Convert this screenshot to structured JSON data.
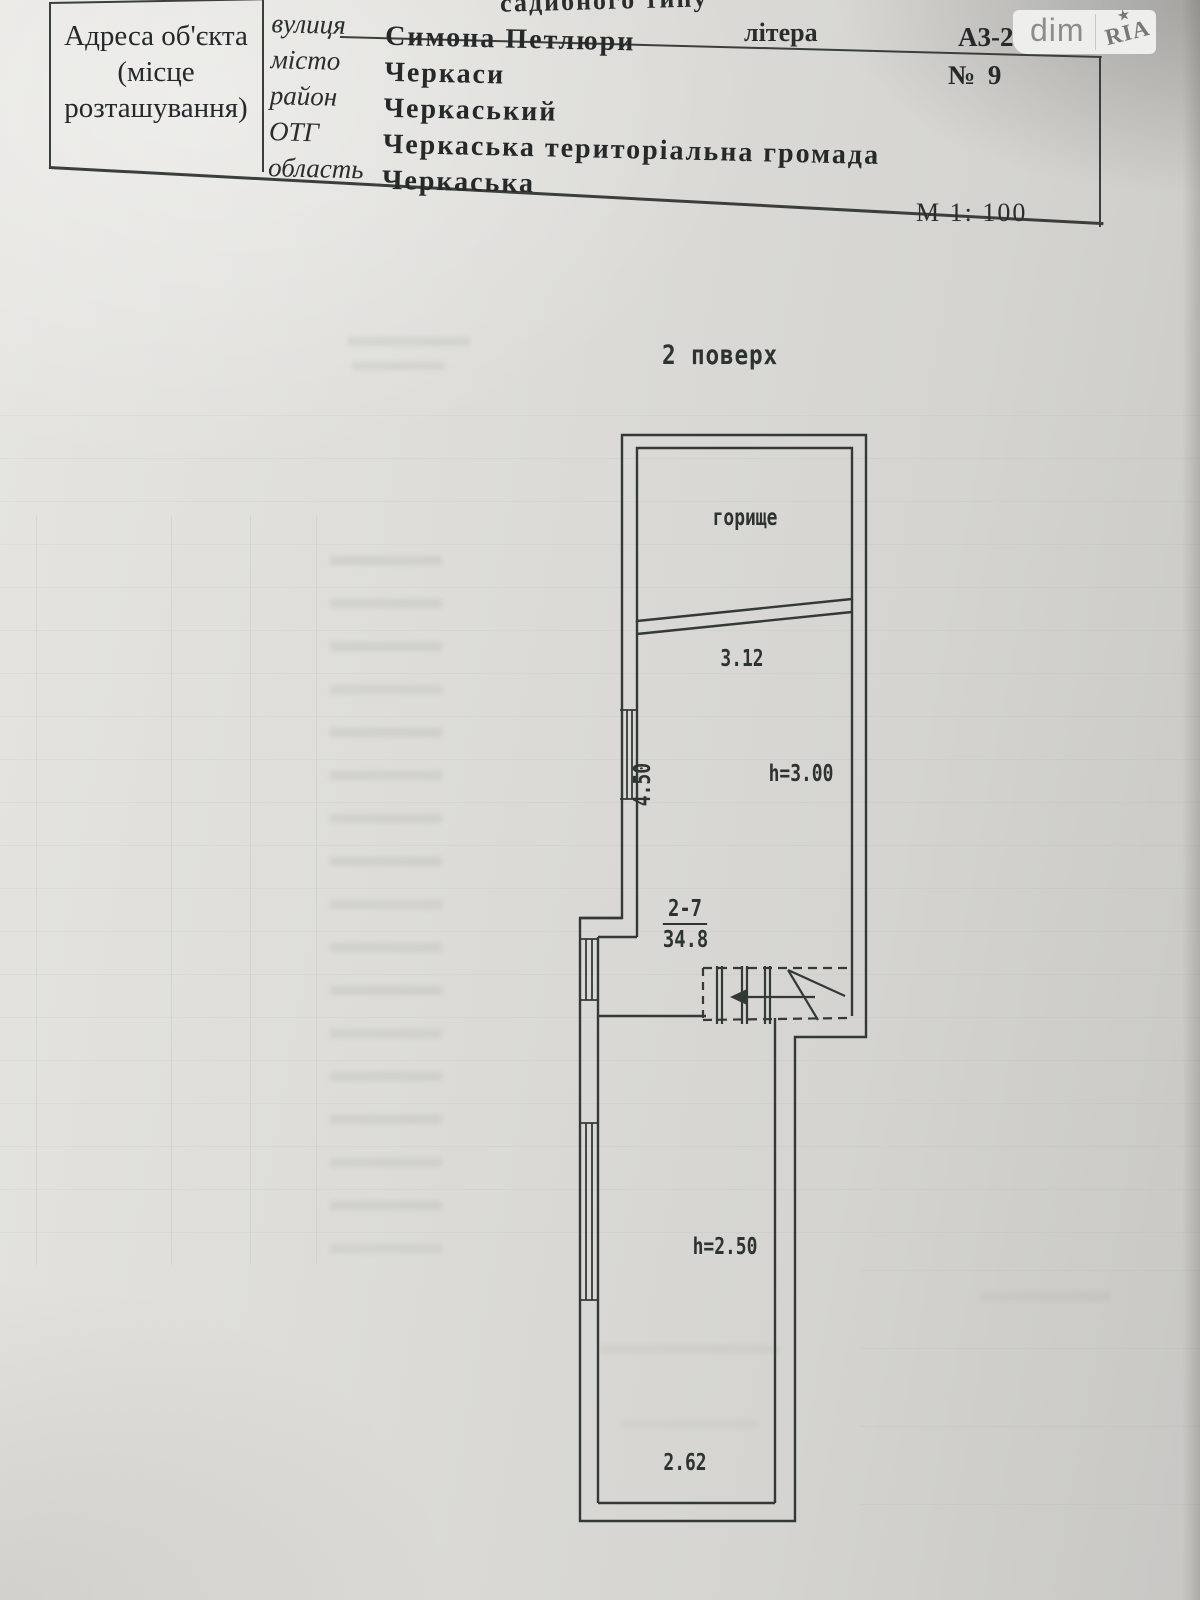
{
  "document": {
    "header": {
      "building_type_fragment": "садибного типу",
      "litera_label": "літера",
      "litera_value": "А3-2",
      "house_number": "№ 9",
      "map_scale": "М 1: 100",
      "address_cell_lines": [
        "Адреса об'єкта",
        "(місце",
        "розташування)"
      ],
      "rows": [
        {
          "label": "вулиця",
          "value": "Симона Петлюри"
        },
        {
          "label": "місто",
          "value": "Черкаси"
        },
        {
          "label": "район",
          "value": "Черкаський"
        },
        {
          "label": "ОТГ",
          "value": "Черкаська територіальна громада"
        },
        {
          "label": "область",
          "value": "Черкаська"
        }
      ]
    },
    "watermark": {
      "dim": "dim",
      "ria": "RIA",
      "star": "★"
    }
  },
  "plan": {
    "floor_title": "2 поверх",
    "attic_label": "горище",
    "dim_width_top": "3.12",
    "dim_side": "4.50",
    "height_mid": "h=3.00",
    "room_number": "2-7",
    "room_area": "34.8",
    "height_low": "h=2.50",
    "dim_width_bottom": "2.62",
    "colors": {
      "line": "#333a35",
      "paper": "#dcdbd7"
    }
  }
}
